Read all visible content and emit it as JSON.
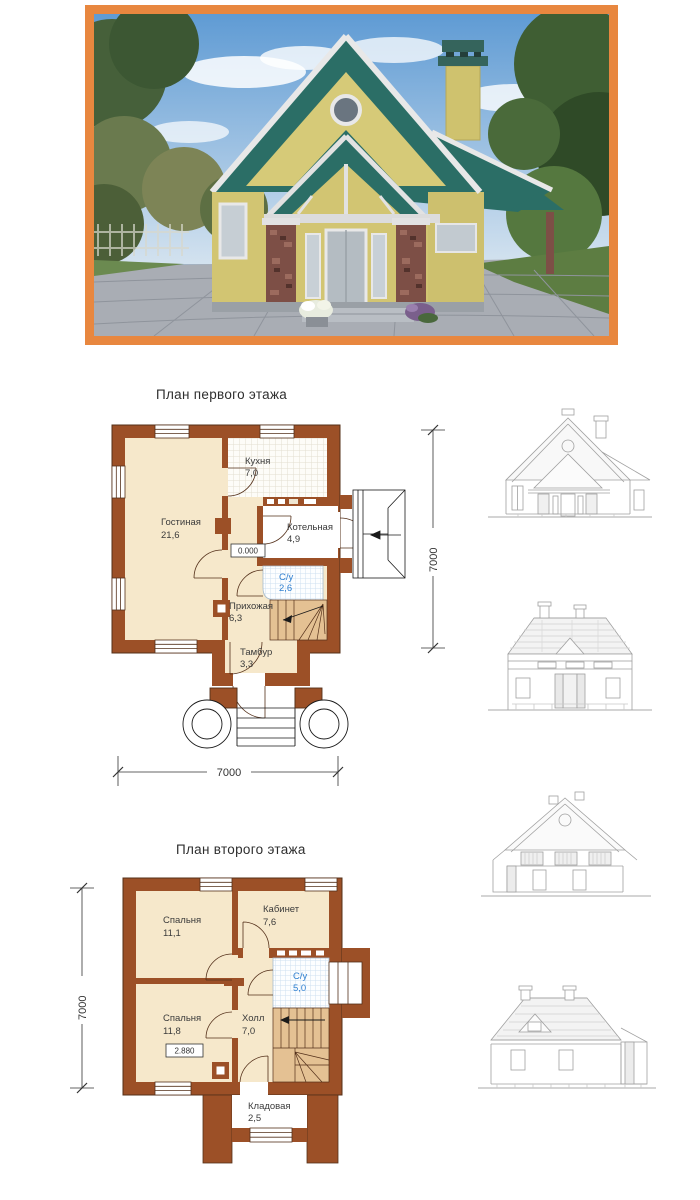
{
  "photo": {
    "description": "Rendered exterior view of a two-storey cottage: green shingle roof, pale-yellow stucco walls, stone entry columns, grey paved driveway, trees and blue sky around",
    "frame_color": "#E8873F"
  },
  "first_floor": {
    "title": "План первого этажа",
    "level_mark": "0.000",
    "dim_bottom": "7000",
    "dim_right": "7000",
    "rooms": [
      {
        "name": "Гостиная",
        "area": "21,6"
      },
      {
        "name": "Кухня",
        "area": "7,0"
      },
      {
        "name": "Котельная",
        "area": "4,9"
      },
      {
        "name": "С/у",
        "area": "2,6"
      },
      {
        "name": "Прихожая",
        "area": "6,3"
      },
      {
        "name": "Тамбур",
        "area": "3,3"
      }
    ]
  },
  "second_floor": {
    "title": "План второго этажа",
    "level_mark": "2.880",
    "dim_left": "7000",
    "rooms": [
      {
        "name": "Спальня",
        "area": "11,1"
      },
      {
        "name": "Кабинет",
        "area": "7,6"
      },
      {
        "name": "С/у",
        "area": "5,0"
      },
      {
        "name": "Спальня",
        "area": "11,8"
      },
      {
        "name": "Холл",
        "area": "7,0"
      },
      {
        "name": "Кладовая",
        "area": "2,5"
      }
    ]
  },
  "colors": {
    "wall_brown": "#9C5027",
    "room_cream": "#F6E8CB",
    "stair_tan": "#E4C193",
    "tile_blue_text": "#2F7FD0",
    "elevation_line": "#A0A0A0",
    "roof_teal": "#2B6E66",
    "house_yellow": "#D2C572"
  }
}
